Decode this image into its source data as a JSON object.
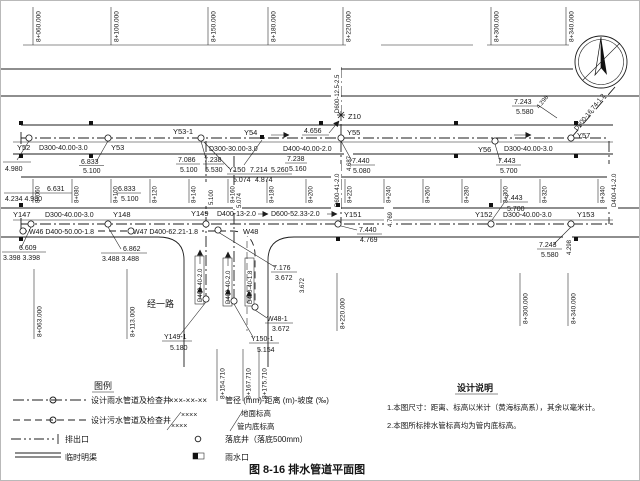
{
  "caption": "图 8-16  排水管道平面图",
  "stations": {
    "top": [
      "8+060.000",
      "8+100.000",
      "8+150.000",
      "8+180.000",
      "8+220.000",
      "8+300.000",
      "8+340.000"
    ],
    "mid": [
      "8+060",
      "8+080",
      "8+100",
      "8+120",
      "8+140",
      "8+160",
      "8+180",
      "8+200",
      "8+220",
      "8+240",
      "8+260",
      "8+280",
      "8+300",
      "8+320",
      "8+340"
    ],
    "bottom": [
      "8+063.000",
      "8+113.000",
      "8+154.710",
      "8+167.710",
      "8+175.710",
      "8+220.000",
      "8+300.000",
      "8+340.000"
    ]
  },
  "manholes": {
    "y52": "Y52",
    "y53": "Y53",
    "y53_1": "Y53-1",
    "y54": "Y54",
    "y55": "Y55",
    "y56": "Y56",
    "y57": "Y57",
    "y147": "Y147",
    "y148": "Y148",
    "y149": "Y149",
    "y150": "Y150",
    "y151": "Y151",
    "y152": "Y152",
    "y153": "Y153",
    "y149_1": "Y149-1",
    "y150_1": "Y150-1",
    "w48": "W48",
    "w48_1": "W48-1",
    "z10": "Z10"
  },
  "pipes": {
    "d300_40": "D300-40.00-3.0",
    "d300_30": "D300-30.00-3.0",
    "d400_40": "D400-40.00-2.0",
    "w46": "W46 D400-50.00-1.8",
    "w47": "W47 D400-62.21-1.8",
    "d400_13": "D400-13-2.0",
    "d600_52": "D600-52.33-2.0",
    "d600_125": "D600-12.5-2.5",
    "d600_41": "D600-41-2.0",
    "d400_41": "D400-41-2.0",
    "d600_167": "D600-16.74-1.2",
    "d400_40v": "D400-40-2.0",
    "d400_40v18": "D400-40-1.8"
  },
  "elev": {
    "e4980": "4.980",
    "e6833": "6.833",
    "e5100": "5.100",
    "e7086": "7.086",
    "e7238": "7.238",
    "e5530": "5.530",
    "e7214": "7.214",
    "e5260": "5.260",
    "e5074": "5.074",
    "e4874": "4.874",
    "e5160": "5.160",
    "e4656": "4.656",
    "e7440": "7.440",
    "e5080": "5.080",
    "e4687": "4.687",
    "e7443": "7.443",
    "e5700": "5.700",
    "e7243": "7.243",
    "e5580": "5.580",
    "e4298": "4.298",
    "e6631": "6.631",
    "e4234_4980": "4.234 4.980",
    "e6609": "6.609",
    "e3398": "3.398 3.398",
    "e6862": "6.862",
    "e3488": "3.488 3.488",
    "e4769": "4.769",
    "e7176": "7.176",
    "e3672": "3.672",
    "e5180": "5.180",
    "e5154": "5.154"
  },
  "road": {
    "name": "经一路"
  },
  "legend": {
    "title": "图例",
    "rain": "设计雨水管道及检查井",
    "sewage": "设计污水管道及检查井",
    "outfall": "排出口",
    "channel": "临时明渠",
    "code": "×××-××-××",
    "code_desc": "管径 (mm)-距离 (m)-坡度 (‰)",
    "elev_top": "××××",
    "elev_bot": "××××",
    "ground": "地面标高",
    "invert": "管内底标高",
    "drop_well": "落底井（落底500mm）",
    "inlet": "雨水口"
  },
  "notes": {
    "title": "设计说明",
    "n1": "1.本图尺寸：距离、标高以米计（黄海标高系），其余以毫米计。",
    "n2": "2.本图所标排水管标高均为管内底标高。"
  }
}
